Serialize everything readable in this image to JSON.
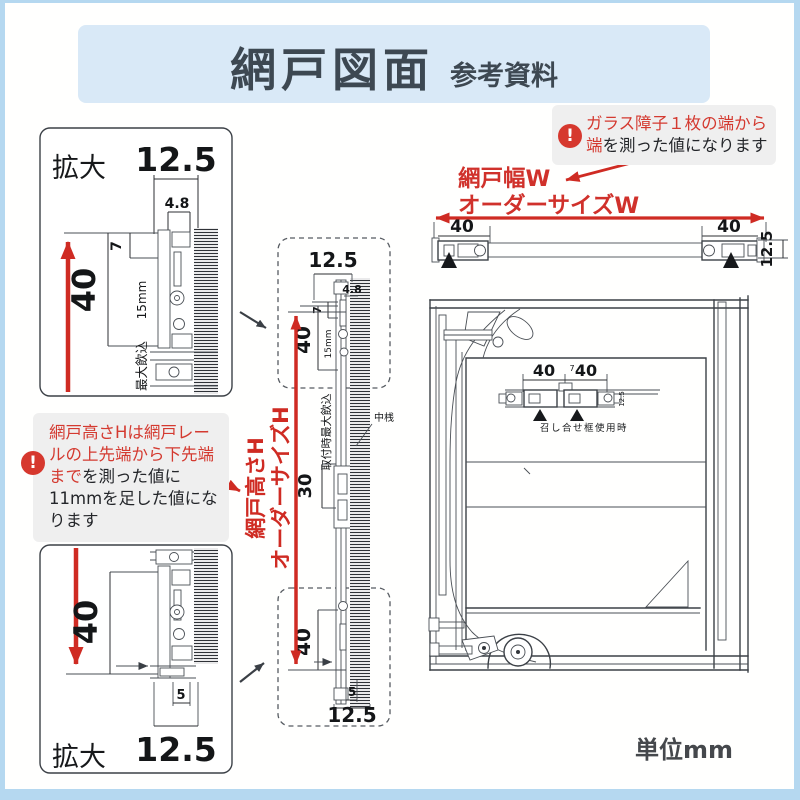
{
  "colors": {
    "accent_red": "#cf2b23",
    "header_bg": "#d9e9f7",
    "page_border": "#b5d8f0",
    "note_bg": "#efefef",
    "title_color": "#3d4852",
    "line_ink": "#3c4147"
  },
  "icons": {
    "alert": "!"
  },
  "header": {
    "title": "網戸図面",
    "subtitle": "参考資料"
  },
  "notes": {
    "width": {
      "line1": "ガラス障子１枚の端から",
      "line2_red": "端",
      "line2_rest": "を測った値になります"
    },
    "height": {
      "red": "網戸高さHは網戸レールの上先端から下先端まで",
      "rest": "を測った値に11mmを足した値になります"
    }
  },
  "labels": {
    "screen_width_line1": "網戸幅W",
    "screen_width_line2": "オーダーサイズW",
    "screen_height_line1": "網戸高さH",
    "screen_height_line2": "オーダーサイズH",
    "unit": "単位mm"
  },
  "diagrams": {
    "detail_top": {
      "title": "拡大",
      "dim_width": "12.5",
      "dim_offset": "4.8",
      "dim_gap": "7",
      "dim_height": "40",
      "engage_len": "15mm",
      "engage_label": "最大飲込"
    },
    "section_v": {
      "dim_width": "12.5",
      "dim_offset": "4.8",
      "dim_gap": "7",
      "dim_top": "40",
      "engage_len": "15mm",
      "engage_label": "取付時最大飲込",
      "dim_mid": "30",
      "mid_rail": "中桟",
      "dim_bottom": "40",
      "dim_bottom_gap": "5",
      "dim_bottom_width": "12.5"
    },
    "detail_bottom": {
      "title": "拡大",
      "dim_height": "40",
      "dim_gap": "5",
      "dim_width": "12.5"
    },
    "section_h": {
      "dim_left": "40",
      "dim_right": "40",
      "dim_thickness": "12.5"
    },
    "window": {
      "dim_left": "40",
      "dim_right": "40",
      "dim_small": "7",
      "dim_side": "12.5",
      "caption": "召し合せ框使用時"
    }
  }
}
